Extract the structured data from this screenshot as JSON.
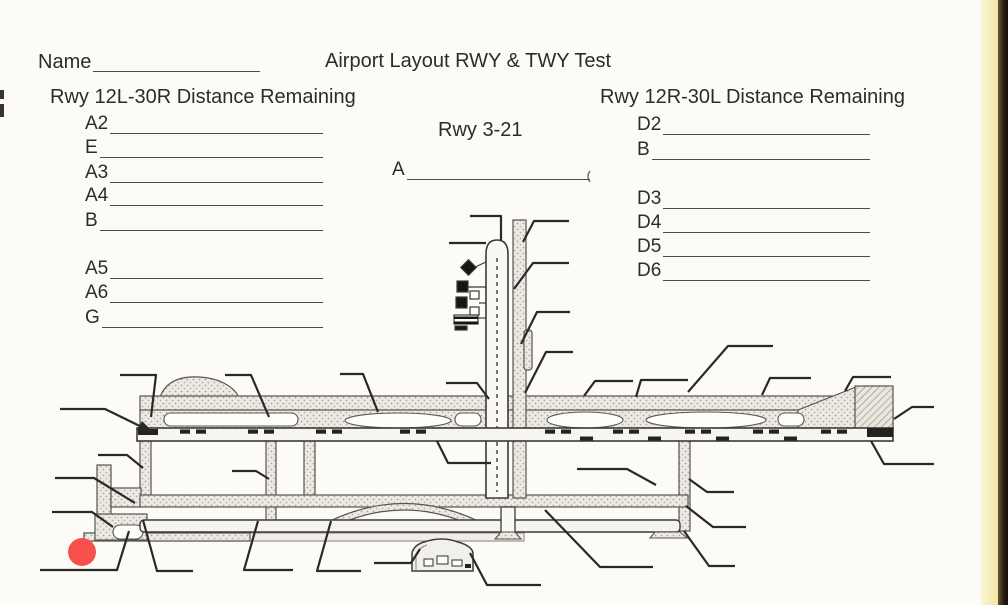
{
  "header": {
    "name_label": "Name",
    "title": "Airport Layout RWY & TWY Test"
  },
  "sections": {
    "left": {
      "heading": "Rwy 12L-30R Distance Remaining",
      "items": [
        "A2",
        "E",
        "A3",
        "A4",
        "B",
        "A5",
        "A6",
        "G"
      ]
    },
    "middle": {
      "heading": "Rwy 3-21",
      "items": [
        "A"
      ]
    },
    "right": {
      "heading": "Rwy 12R-30L Distance Remaining",
      "items": [
        "D2",
        "B",
        "D3",
        "D4",
        "D5",
        "D6"
      ]
    }
  },
  "annotations": {
    "red_marker_color": "#f8514d"
  },
  "page_colors": {
    "paper": "#fcfbf8",
    "ink": "#2d2c29",
    "edge_yellow": "#f1e6a4",
    "edge_dark": "#241c10"
  }
}
